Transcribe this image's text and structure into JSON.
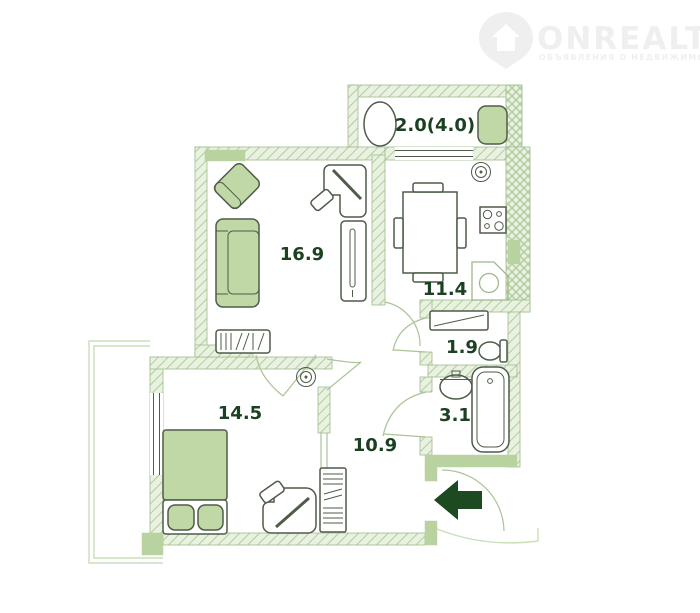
{
  "logo": {
    "brand": "ONREALT",
    "tagline": "ОБЪЯВЛЕНИЯ О НЕДВИЖИМОСТИ"
  },
  "plan": {
    "rooms": {
      "balcony": {
        "label": "2.0(4.0)"
      },
      "living": {
        "label": "16.9"
      },
      "kitchen": {
        "label": "11.4"
      },
      "wc": {
        "label": "1.9"
      },
      "bath": {
        "label": "3.1"
      },
      "bedroom": {
        "label": "14.5"
      },
      "hall": {
        "label": "10.9"
      }
    },
    "entrance": {
      "direction": "left"
    },
    "furniture_icons": [
      "balcony-table",
      "balcony-chair",
      "armchair",
      "sofa",
      "tv-stand",
      "desk",
      "office-chair",
      "wardrobe",
      "dining-table",
      "dining-chairs",
      "stove",
      "corner-sink",
      "ceiling-lamp",
      "shelf",
      "toilet",
      "washbasin",
      "bathtub",
      "double-bed",
      "pillows",
      "bedroom-desk",
      "hall-wardrobe",
      "entrance-arrow"
    ],
    "colors": {
      "wall_fill": "#e9f1e0",
      "wall_hatch_line": "#b3cc9f",
      "wall_stroke": "#9fbd8d",
      "wall_solid": "#b9d3a0",
      "furniture_fill": "#c0d8a6",
      "outline_dark": "#4e5c49",
      "outline_light": "#9cb98a",
      "door_stroke": "#a9c496",
      "ledge_stroke": "#cadfbb",
      "label_color": "#1b4022",
      "arrow_color": "#1d4a20",
      "logo_color": "#efefef"
    }
  }
}
